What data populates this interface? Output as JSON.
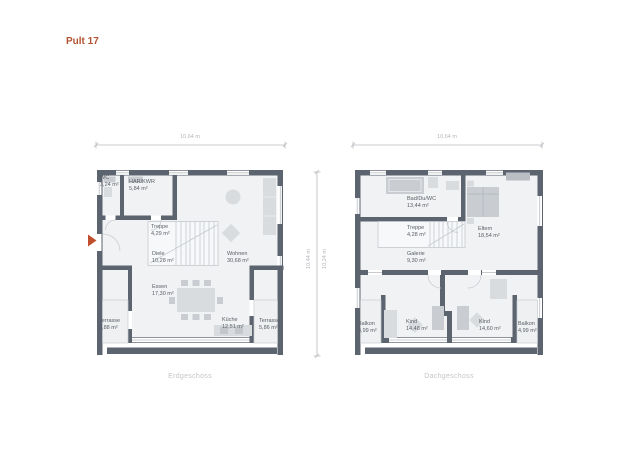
{
  "title": "Pult 17",
  "colors": {
    "title": "#b25231",
    "wall": "#5c6470",
    "room_fill": "#f1f2f4",
    "furniture_light": "#d9dcdf",
    "furniture_mid": "#c9cdd2",
    "dimension": "#b9bcc0",
    "room_label": "#585e66",
    "caption": "#c2c5c8",
    "entrance_arrow": "#c04f2e"
  },
  "floors": [
    {
      "id": "erdgeschoss",
      "caption": "Erdgeschoss",
      "width_dim": "10,64 m",
      "rooms": [
        {
          "name": "WC",
          "area": "3,24 m²"
        },
        {
          "name": "HAR/KWR",
          "area": "5,84 m²"
        },
        {
          "name": "Treppe",
          "area": "4,29 m²"
        },
        {
          "name": "Diele",
          "area": "10,28 m²"
        },
        {
          "name": "Wohnen",
          "area": "30,68 m²"
        },
        {
          "name": "Essen",
          "area": "17,30 m²"
        },
        {
          "name": "Küche",
          "area": "12,51 m²"
        },
        {
          "name": "Terrasse",
          "area": "5,88 m²"
        },
        {
          "name": "Terrasse",
          "area": "5,86 m²"
        }
      ]
    },
    {
      "id": "dachgeschoss",
      "caption": "Dachgeschoss",
      "width_dim": "10,64 m",
      "rooms": [
        {
          "name": "Bad/Du/WC",
          "area": "13,44 m²"
        },
        {
          "name": "Treppe",
          "area": "4,28 m²"
        },
        {
          "name": "Galerie",
          "area": "9,30 m²"
        },
        {
          "name": "Eltern",
          "area": "18,54 m²"
        },
        {
          "name": "Balkon",
          "area": "4,99 m²"
        },
        {
          "name": "Kind",
          "area": "14,48 m²"
        },
        {
          "name": "Kind",
          "area": "14,60 m²"
        },
        {
          "name": "Balkon",
          "area": "4,99 m²"
        }
      ]
    }
  ],
  "vertical_dims": {
    "left": "10,44 m",
    "right": "10,24 m"
  }
}
